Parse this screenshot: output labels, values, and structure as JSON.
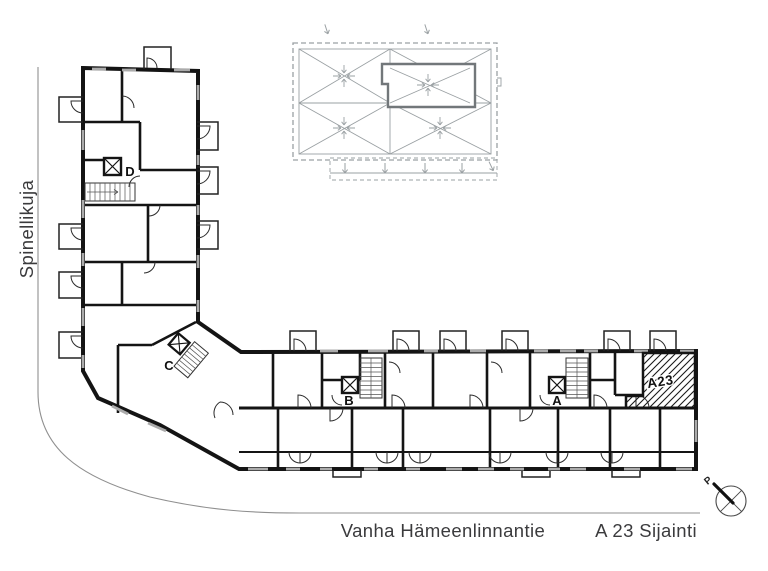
{
  "streets": {
    "left_street": "Spinellikuja",
    "bottom_street": "Vanha Hämeenlinnantie"
  },
  "caption": "A 23 Sijainti",
  "plan": {
    "highlight_unit": "A23",
    "stairwells": {
      "a": "A",
      "b": "B",
      "c": "C",
      "d": "D"
    }
  },
  "compass": {
    "north": "P"
  },
  "colors": {
    "ink": "#141414",
    "roof_gray": "#9aa0a3",
    "street_gray": "#8f8f8f",
    "window_gray": "#ababab",
    "text_gray": "#3b3b3d"
  }
}
